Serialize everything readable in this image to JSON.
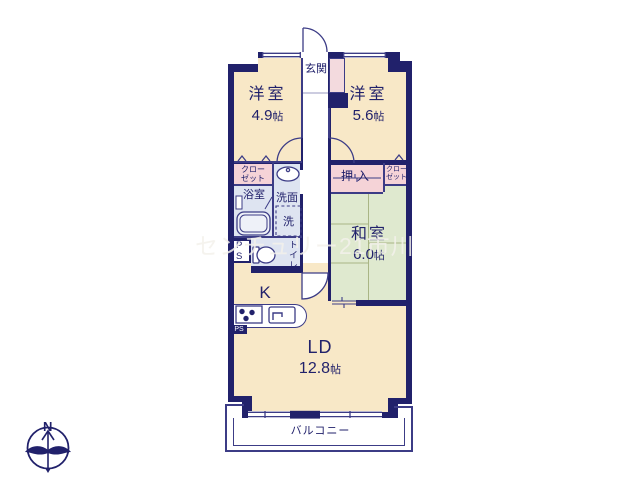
{
  "title": "apartment-floor-plan",
  "watermark": "センチュリー21市川",
  "compass": {
    "north_label": "N"
  },
  "rooms": {
    "genkan": {
      "name": "玄関"
    },
    "bedroom_left": {
      "name": "洋室",
      "size_value": "4.9",
      "size_unit": "帖"
    },
    "bedroom_right": {
      "name": "洋室",
      "size_value": "5.6",
      "size_unit": "帖"
    },
    "closet_left": {
      "line1": "クロー",
      "line2": "ゼット"
    },
    "bathroom": {
      "name": "浴室"
    },
    "washroom": {
      "name": "洗面"
    },
    "laundry": {
      "name": "洗"
    },
    "pipe_space_upper": {
      "line1": "P",
      "line2": "S"
    },
    "toilet": {
      "name": "トイレ"
    },
    "oshiire": {
      "name": "押入"
    },
    "closet_right": {
      "line1": "クロー",
      "line2": "ゼット"
    },
    "washitsu": {
      "name": "和室",
      "size_value": "6.0",
      "size_unit": "帖"
    },
    "kitchen": {
      "name": "K"
    },
    "pipe_space_lower": {
      "name": "PS"
    },
    "living_dining": {
      "name": "LD",
      "size_value": "12.8",
      "size_unit": "帖"
    },
    "balcony": {
      "name": "バルコニー"
    }
  },
  "colors": {
    "wall": "#21216b",
    "thin": "#3c3c86",
    "cream": "#f8e8c7",
    "pink": "#f5d3d7",
    "pinklight": "#f3dade",
    "blue": "#dee4f1",
    "green": "#dfe9cf",
    "tatami": "#a9b585",
    "ink": "#21216b",
    "white": "#ffffff"
  }
}
